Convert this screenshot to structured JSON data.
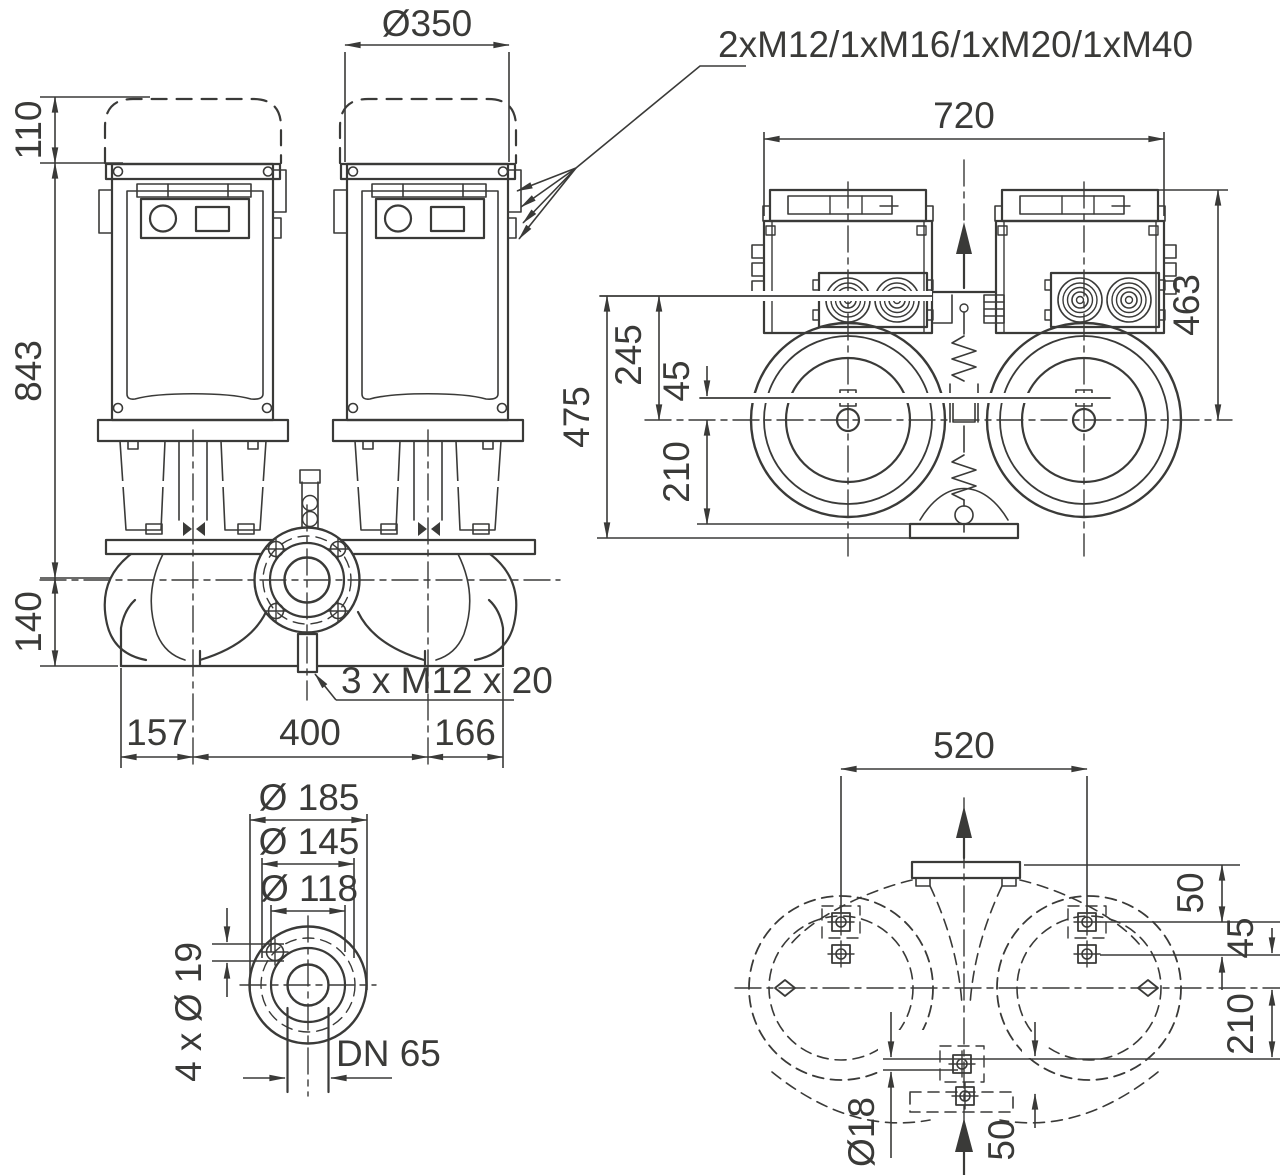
{
  "drawing": {
    "kind": "pump dimension drawing",
    "colors": {
      "line": "#3a3a38",
      "background": "#ffffff"
    },
    "annotations": {
      "cable_glands": "2xM12/1xM16/1xM20/1xM40",
      "flange_screws": "3 x M12 x 20"
    },
    "front_view": {
      "motor_clearance_diameter": "Ø350",
      "clearance_height": "110",
      "height_axis_to_top": "843",
      "axis_to_base": "140",
      "base_left": "157",
      "pump_spacing": "400",
      "base_right": "166"
    },
    "top_view": {
      "overall_length": "720",
      "depth_to_axis": "463",
      "overall_width": "475",
      "front_to_axis": "245",
      "gland_to_axis": "45",
      "axis_to_foot": "210"
    },
    "flange_detail": {
      "outer_diameter": "Ø 185",
      "bolt_circle": "Ø 145",
      "raised_face": "Ø 118",
      "bolt_holes": "4 x Ø 19",
      "nominal_bore": "DN 65"
    },
    "footprint_view": {
      "bolt_spacing": "520",
      "edge_to_bolt": "50",
      "bolt_row_gap": "45",
      "axis_to_hole": "210",
      "hole_diameter": "Ø18",
      "foot_offset": "50"
    }
  }
}
